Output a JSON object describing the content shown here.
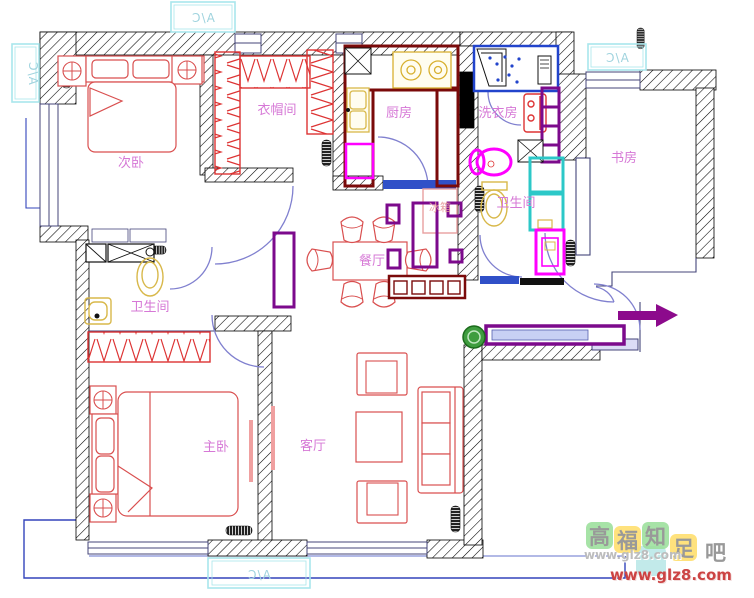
{
  "colors": {
    "wall_hatch": "#000000",
    "furniture_red": "#d94f4f",
    "kitchen_counter_maroon": "#7a0a0a",
    "fixture_yellow": "#d8b84a",
    "magenta_fixture": "#ff00ff",
    "shower_cyan": "#2cc8c8",
    "threshold_blue": "#3050c8",
    "door_arc_blue": "#8080cf",
    "cabinet_purple": "#7c0a8c",
    "room_label_pink": "#d678d6",
    "ac_box_cyan": "#a8e6ec",
    "green_marker": "#3f9d3f",
    "window_line_navy": "#44457a",
    "balcony_line_blue": "#3344bb"
  },
  "rooms": [
    {
      "id": "secondary-bedroom",
      "label": "次卧"
    },
    {
      "id": "cloakroom",
      "label": "衣帽间"
    },
    {
      "id": "kitchen",
      "label": "厨房"
    },
    {
      "id": "laundry-room",
      "label": "洗衣房"
    },
    {
      "id": "study",
      "label": "书房"
    },
    {
      "id": "bathroom-right",
      "label": "卫生间"
    },
    {
      "id": "dining-room",
      "label": "餐厅"
    },
    {
      "id": "bathroom-left",
      "label": "卫生间"
    },
    {
      "id": "master-bedroom",
      "label": "主卧"
    },
    {
      "id": "living-room",
      "label": "客厅"
    }
  ],
  "appliances": [
    {
      "id": "fridge",
      "label": "冰箱"
    }
  ],
  "ac_units": [
    {
      "id": "ac-top-left",
      "label": "A/C"
    },
    {
      "id": "ac-left",
      "label": "A/C"
    },
    {
      "id": "ac-top-right",
      "label": "A/C"
    },
    {
      "id": "ac-bottom",
      "label": "A/C"
    }
  ],
  "watermark": {
    "tiles": [
      {
        "char": "高"
      },
      {
        "char": "福"
      },
      {
        "char": "知"
      },
      {
        "char": "足"
      },
      {
        "char": "吧"
      }
    ],
    "url_small": "www.glz8.com",
    "url_large": "www.glz8.com"
  }
}
